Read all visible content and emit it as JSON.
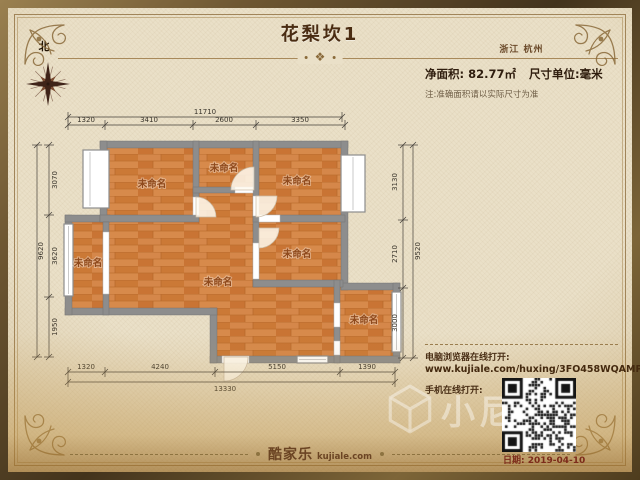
{
  "header": {
    "title": "花梨坎1",
    "location": "浙江 杭州",
    "area": "净面积: 82.77㎡",
    "unit": "尺寸单位:毫米",
    "note": "注:准确面积请以实际尺寸为准",
    "divider_ornament": "❖"
  },
  "compass": {
    "north_label": "北"
  },
  "plan": {
    "rooms": [
      {
        "label": "未命名"
      },
      {
        "label": "未命名"
      },
      {
        "label": "未命名"
      },
      {
        "label": "未命名"
      },
      {
        "label": "未命名"
      },
      {
        "label": "未命名"
      },
      {
        "label": "未命名"
      }
    ],
    "dimensions": {
      "top": {
        "total": "11710",
        "segments": [
          "1320",
          "3410",
          "2600",
          "3350"
        ]
      },
      "left": {
        "total": "9620",
        "segments": [
          "3070",
          "3620",
          "1950"
        ]
      },
      "right": {
        "total": "9520",
        "segments": [
          "3130",
          "2710",
          "3000"
        ]
      },
      "bottom": {
        "total": "13330",
        "segments": [
          "1320",
          "4240",
          "5150",
          "1390"
        ]
      }
    }
  },
  "share": {
    "desktop_label": "电脑浏览器在线打开:",
    "url": "www.kujiale.com/huxing/3FO458WQAMP4",
    "mobile_label": "手机在线打开:",
    "date": "日期: 2019-04-10"
  },
  "footer": {
    "brand": "酷家乐",
    "brand_domain": "kujiale.com"
  },
  "watermark": {
    "text": "小尼"
  },
  "colors": {
    "parchment": "#eae0c8",
    "frame_bronze": "#6b5433",
    "floor_wood": "#d0803f",
    "wall_gray": "#8d8d8d",
    "accent_brown": "#4a2c12",
    "date_red": "#7c2b1a"
  }
}
